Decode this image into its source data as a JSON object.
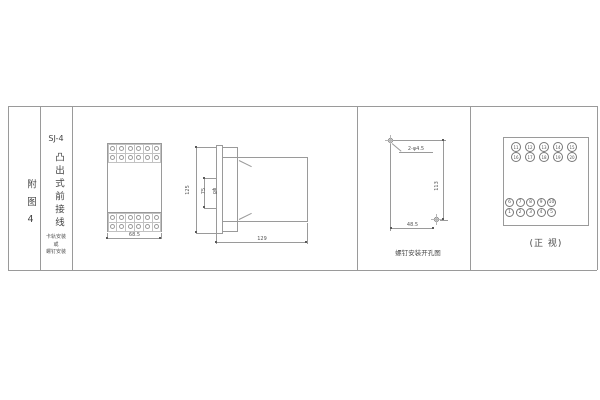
{
  "colors": {
    "line": "#9a9a9a",
    "text": "#4a4a4a"
  },
  "index_column": {
    "label": "附图4"
  },
  "title_column": {
    "model": "SJ-4",
    "title_vertical": "凸出式前接线",
    "mount_lines": [
      "卡轨安装",
      "或",
      "螺钉安装"
    ]
  },
  "front_view": {
    "width_dim": "68.5"
  },
  "side_view": {
    "height_dim": "125",
    "span_dim": "75",
    "screw_dim": "φ8",
    "depth_dim": "129"
  },
  "drill_view": {
    "hole_label": "2-φ4.5",
    "height_dim": "113",
    "width_dim": "48.5",
    "caption": "螺钉安装开孔图"
  },
  "terminal_view": {
    "rows_top": [
      [
        "11",
        "12",
        "13",
        "14",
        "15"
      ],
      [
        "16",
        "17",
        "18",
        "19",
        "20"
      ]
    ],
    "rows_bottom": [
      [
        "6",
        "7",
        "8",
        "9",
        "10"
      ],
      [
        "1",
        "2",
        "3",
        "4",
        "5"
      ]
    ],
    "caption": "(正 视)"
  }
}
